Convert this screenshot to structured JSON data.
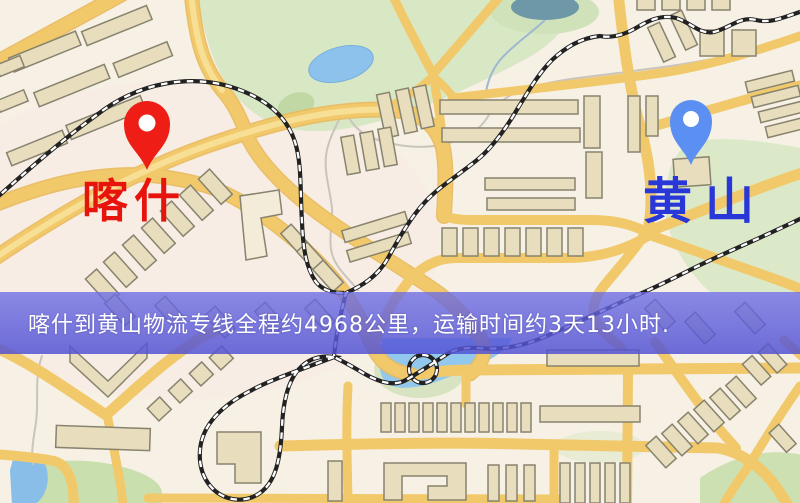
{
  "map": {
    "markers": {
      "origin": {
        "label": "喀什",
        "icon": "map-pin",
        "pin_color": "#ee1d15",
        "label_color": "#e6140c"
      },
      "destination": {
        "label": "黄山",
        "icon": "map-pin",
        "pin_color": "#5c8ff2",
        "label_color": "#2737d8"
      }
    },
    "banner": {
      "text": "喀什到黄山物流专线全程约4968公里，运输时间约3天13小时.",
      "background": "#5a5ad8",
      "text_color": "#ffffff"
    },
    "route_info": {
      "origin": "喀什",
      "destination": "黄山",
      "distance": "约4968公里",
      "duration": "约3天13小时"
    },
    "palette": {
      "land": "#f7f0e5",
      "road": "#f1c96a",
      "road_minor": "#f6d98a",
      "building_fill": "#e8ddbd",
      "building_stroke": "#87836e",
      "park": "#d8e7c4",
      "water": "#8fc6ee",
      "railway": "#222222"
    }
  }
}
